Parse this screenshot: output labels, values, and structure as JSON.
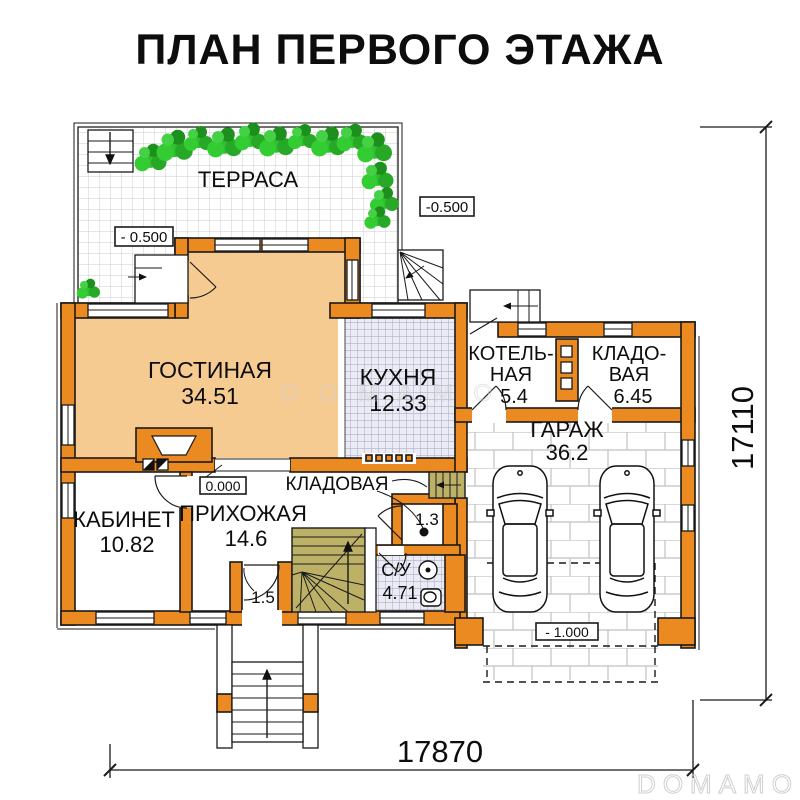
{
  "title": "ПЛАН ПЕРВОГО ЭТАЖА",
  "rooms": {
    "terrace": {
      "name": "ТЕРРАСА"
    },
    "living": {
      "name": "ГОСТИНАЯ",
      "area": "34.51"
    },
    "kitchen": {
      "name": "КУХНЯ",
      "area": "12.33"
    },
    "boiler": {
      "name_line1": "КОТЕЛЬ-",
      "name_line2": "НАЯ",
      "area": "5.4"
    },
    "pantry": {
      "name_line1": "КЛАДО-",
      "name_line2": "ВАЯ",
      "area": "6.45"
    },
    "garage": {
      "name": "ГАРАЖ",
      "area": "36.2"
    },
    "office": {
      "name": "КАБИНЕТ",
      "area": "10.82"
    },
    "hallway": {
      "name": "ПРИХОЖАЯ",
      "area": "14.6"
    },
    "storage": {
      "name": "КЛАДОВАЯ",
      "area": "1.3"
    },
    "bathroom": {
      "name": "С/У",
      "area": "4.71"
    },
    "vestibule": {
      "area": "1.5"
    }
  },
  "elevations": {
    "terrace_left": "- 0.500",
    "terrace_right": "-0.500",
    "entry": "0.000",
    "garage": "- 1.000"
  },
  "dimensions": {
    "width_bottom": "17870",
    "height_right": "17110"
  },
  "watermark": {
    "center": "D O M A M O",
    "corner": "DOMAMO"
  },
  "colors": {
    "wall": "#EA8A20",
    "living": "#F6CB92",
    "stairs": "#BDB168",
    "tile": "#EBEBF5",
    "plant": "#2FBF2F",
    "watermark": "#cfcfcf"
  }
}
